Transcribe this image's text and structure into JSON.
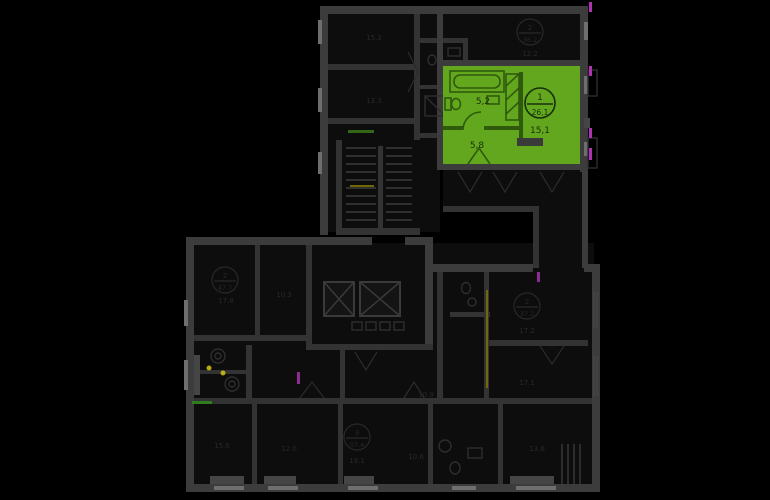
{
  "palette": {
    "background": "#000000",
    "highlight": "#63a71e",
    "highlight_dark": "#2f5a0c",
    "wall": "#3c3c3c",
    "room": "#0d0d0d",
    "window": "#6e6e6e",
    "dim_text": "#282828",
    "accent_purple": "#b032b2",
    "accent_yellow": "#c2b000",
    "accent_green": "#3f7d1c"
  },
  "highlighted_apartment": {
    "number": "1",
    "total_area": "26,1",
    "rooms": [
      {
        "label": "5,2"
      },
      {
        "label": "5,8"
      },
      {
        "label": "15,1"
      }
    ]
  },
  "dim_labels": {
    "top_left_room_1": "15.2",
    "top_left_room_2": "13.3",
    "top_apartment_number": "2",
    "top_apartment_area": "36.2",
    "top_apartment_room": "12.2",
    "left_apartment_number": "2",
    "left_apartment_area": "47.7",
    "left_apartment_room": "17.8",
    "left_apartment_room_2": "10.3",
    "right_apartment_number": "2",
    "right_apartment_area": "37.2",
    "right_apartment_room_1": "17.2",
    "right_apartment_room_2": "17.1",
    "bottom_apartment_number": "3",
    "bottom_apartment_area": "57.4",
    "bottom_apartment_room": "19.1",
    "bottom_room_1": "15.6",
    "bottom_room_2": "12.0",
    "bottom_room_3": "13.6",
    "bottom_room_4": "10.6",
    "hall_room": "10.9"
  }
}
